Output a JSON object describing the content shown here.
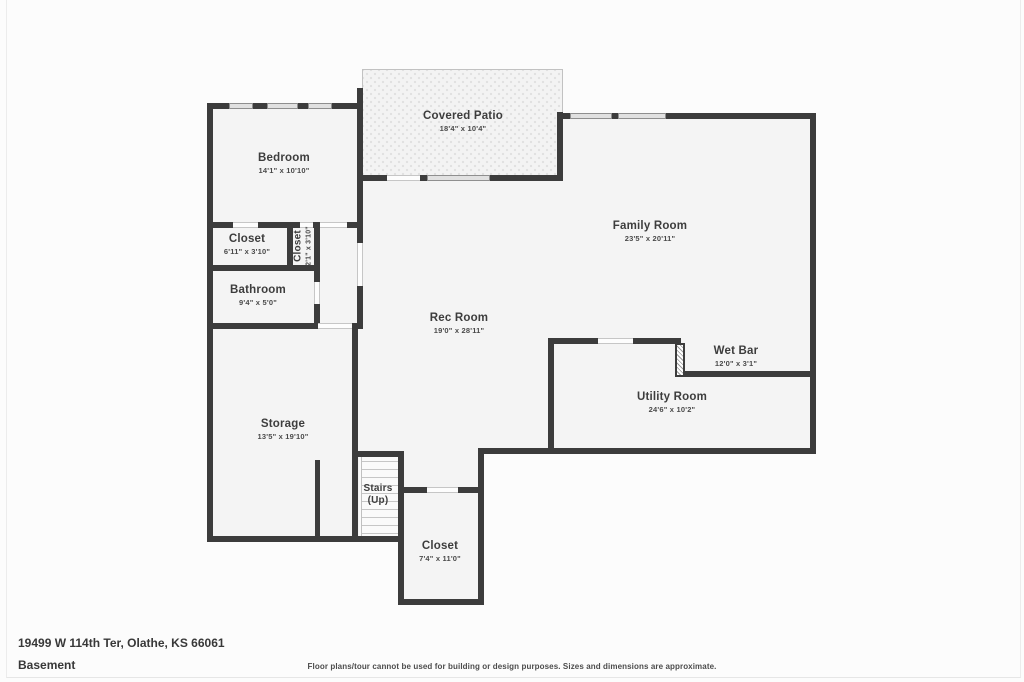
{
  "plan": {
    "title_note": "Basement floor plan",
    "rooms": [
      {
        "name": "Bedroom",
        "dims": "14'1\" x 10'10\""
      },
      {
        "name": "Covered Patio",
        "dims": "18'4\" x 10'4\""
      },
      {
        "name": "Closet",
        "dims": "6'11\" x 3'10\""
      },
      {
        "name": "Closet",
        "dims": "2'1\" x 3'10\""
      },
      {
        "name": "Bathroom",
        "dims": "9'4\" x 5'0\""
      },
      {
        "name": "Family Room",
        "dims": "23'5\" x 20'11\""
      },
      {
        "name": "Rec Room",
        "dims": "19'0\" x 28'11\""
      },
      {
        "name": "Wet Bar",
        "dims": "12'0\" x 3'1\""
      },
      {
        "name": "Utility Room",
        "dims": "24'6\" x 10'2\""
      },
      {
        "name": "Storage",
        "dims": "13'5\" x 19'10\""
      },
      {
        "name": "Stairs",
        "dims": "(Up)"
      },
      {
        "name": "Closet",
        "dims": "7'4\" x 11'0\""
      }
    ]
  },
  "footer": {
    "address": "19499 W 114th Ter, Olathe, KS 66061",
    "level": "Basement",
    "disclaimer": "Floor plans/tour cannot be used for building or design purposes. Sizes and dimensions are approximate."
  },
  "colors": {
    "wall": "#3c3c3c",
    "room_fill": "#f4f4f4",
    "background": "#fcfcfc",
    "window_fill": "#e1e1e1",
    "text": "#3f3f3f"
  }
}
